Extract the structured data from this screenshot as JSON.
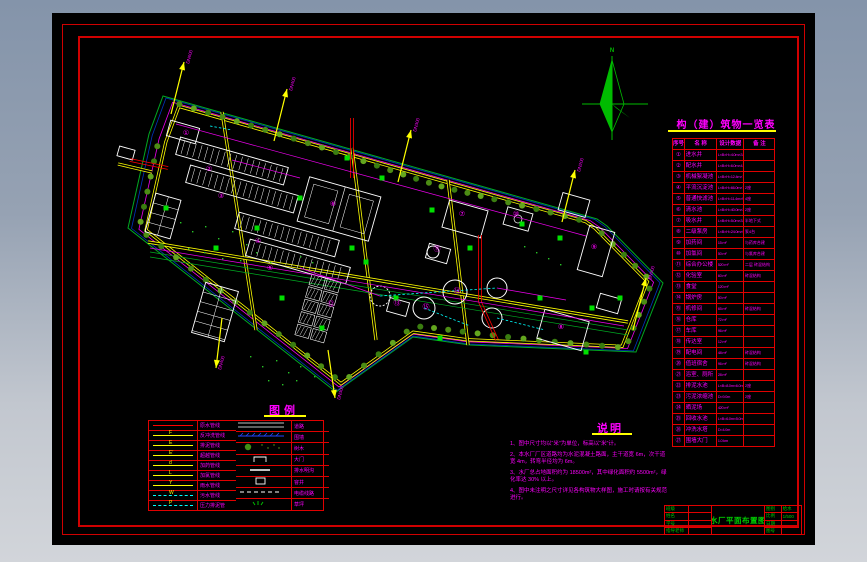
{
  "drawing": {
    "compass_label": "N",
    "arrow_labels": [
      "DN600",
      "DN400",
      "DN300",
      "DN200",
      "DN500",
      "DN400",
      "DN300"
    ],
    "building_numbers": [
      "①",
      "②",
      "③",
      "④",
      "⑤",
      "⑥",
      "⑦",
      "⑧",
      "⑨",
      "⑩",
      "⑪",
      "⑫",
      "⑬",
      "⑭",
      "⑮"
    ],
    "colors": {
      "boundary_green": "#00aa22",
      "boundary_blue": "#0033bb",
      "fence_magenta": "#ee00ee",
      "road_yellow": "#ffff00",
      "building_white": "#ffffff",
      "pipe_red": "#ff0000",
      "pipe_cyan": "#00ffff",
      "valve_green": "#00e000",
      "compass_green": "#00bb00"
    }
  },
  "structure_table": {
    "title": "构（建）筑物一览表",
    "headers": [
      "序号",
      "名  称",
      "设计数据",
      "备 注"
    ],
    "rows": [
      {
        "no": "①",
        "name": "进水井",
        "data": "L×B×H=4.0m×3.5m×4.5m",
        "note": ""
      },
      {
        "no": "②",
        "name": "配水井",
        "data": "L×B×H=6.0m×4.0m×4.2m",
        "note": ""
      },
      {
        "no": "③",
        "name": "机械絮凝池",
        "data": "L×B×H=12.4m×7.8m×4.6m",
        "note": ""
      },
      {
        "no": "④",
        "name": "平流沉淀池",
        "data": "L×B×H=66.0m×7.8m×3.8m",
        "note": "2座"
      },
      {
        "no": "⑤",
        "name": "普通快滤池",
        "data": "L×B×H=11.4m×9.2m×3.5m",
        "note": "4座"
      },
      {
        "no": "⑥",
        "name": "清水池",
        "data": "L×B×H=40.0m×30.0m×4.0m",
        "note": "2座"
      },
      {
        "no": "⑦",
        "name": "吸水井",
        "data": "L×B×H=5.0m×3.0m×5.0m",
        "note": "半地下式"
      },
      {
        "no": "⑧",
        "name": "二级泵房",
        "data": "L×B×H=24.0m×9.0m×6.0m",
        "note": "泵4台"
      },
      {
        "no": "⑨",
        "name": "加药间",
        "data": "15 m²",
        "note": "与药库合建"
      },
      {
        "no": "⑩",
        "name": "加氯间",
        "data": "50 m²",
        "note": "与氯库合建"
      },
      {
        "no": "⑪",
        "name": "综合办公楼",
        "data": "520 m²",
        "note": "二层 砖混结构"
      },
      {
        "no": "⑫",
        "name": "化验室",
        "data": "60 m²",
        "note": "砖混结构"
      },
      {
        "no": "⑬",
        "name": "食堂",
        "data": "120 m²",
        "note": ""
      },
      {
        "no": "⑭",
        "name": "锅炉房",
        "data": "50 m²",
        "note": ""
      },
      {
        "no": "⑮",
        "name": "机修间",
        "data": "65 m²",
        "note": "砖混结构"
      },
      {
        "no": "⑯",
        "name": "仓库",
        "data": "72 m²",
        "note": ""
      },
      {
        "no": "⑰",
        "name": "车库",
        "data": "96 m²",
        "note": ""
      },
      {
        "no": "⑱",
        "name": "传达室",
        "data": "12 m²",
        "note": ""
      },
      {
        "no": "⑲",
        "name": "配电间",
        "data": "48 m²",
        "note": "砖混结构"
      },
      {
        "no": "⑳",
        "name": "值班宿舍",
        "data": "96 m²",
        "note": "砖混结构"
      },
      {
        "no": "㉑",
        "name": "浴室、厕所",
        "data": "28 m²",
        "note": ""
      },
      {
        "no": "㉒",
        "name": "排泥水池",
        "data": "L×B=8.0m×6.0m",
        "note": "2座"
      },
      {
        "no": "㉓",
        "name": "污泥浓缩池",
        "data": "D=9.0m",
        "note": "2座"
      },
      {
        "no": "㉔",
        "name": "晒泥场",
        "data": "420 m²",
        "note": ""
      },
      {
        "no": "㉕",
        "name": "回收水池",
        "data": "L×B=6.0m×5.0m",
        "note": ""
      },
      {
        "no": "㉖",
        "name": "冲洗水塔",
        "data": "D=4.0m",
        "note": ""
      },
      {
        "no": "㉗",
        "name": "围墙大门",
        "data": "1.0 km",
        "note": ""
      }
    ]
  },
  "legend": {
    "title": "图例",
    "left": [
      {
        "code": "",
        "label": "原水管线",
        "style": "red"
      },
      {
        "code": "F",
        "label": "反冲洗管线",
        "style": "yellow"
      },
      {
        "code": "E",
        "label": "排泥管线",
        "style": "yellow"
      },
      {
        "code": "E′",
        "label": "超越管线",
        "style": "yellow"
      },
      {
        "code": "d",
        "label": "加药管线",
        "style": "yellow"
      },
      {
        "code": "L",
        "label": "加氯管线",
        "style": "yellow"
      },
      {
        "code": "Y",
        "label": "雨水管线",
        "style": "yellow"
      },
      {
        "code": "W",
        "label": "污水管线",
        "style": "cyan"
      },
      {
        "code": "P",
        "label": "压力排泥管",
        "style": "cyan"
      }
    ],
    "right": [
      {
        "label": "道路",
        "sym": "road"
      },
      {
        "label": "围墙",
        "sym": "wall"
      },
      {
        "label": "树木",
        "sym": "tree"
      },
      {
        "label": "大门",
        "sym": "gate"
      },
      {
        "label": "排水明沟",
        "sym": "ditch"
      },
      {
        "label": "窨井",
        "sym": "manhole"
      },
      {
        "label": "电缆线路",
        "sym": "cable"
      },
      {
        "label": "草坪",
        "sym": "lawn"
      }
    ]
  },
  "notes": {
    "title": "说明",
    "items": [
      "1、图中尺寸均以“米”为单位，标高以“米”计。",
      "2、本水厂厂区道路均为水泥混凝土路面，主干道宽 6m，次干道宽 4m，转弯半径均为 6m。",
      "3、水厂总占地面积约为 18500m²，其中绿化面积约 5500m²，绿化率达 30% 以上。",
      "4、图中未注明之尺寸详见各构筑物大样图，施工时请按有关规范进行。"
    ]
  },
  "titleblock": {
    "title": "水厂平面布置图",
    "left_rows": [
      {
        "label": "班级",
        "value": ""
      },
      {
        "label": "姓名",
        "value": ""
      },
      {
        "label": "学号",
        "value": ""
      },
      {
        "label": "指导老师",
        "value": ""
      }
    ],
    "right_rows": [
      {
        "label": "图别",
        "value": "给水"
      },
      {
        "label": "比例",
        "value": "1/500"
      },
      {
        "label": "日期",
        "value": ""
      },
      {
        "label": "图号",
        "value": ""
      }
    ]
  }
}
